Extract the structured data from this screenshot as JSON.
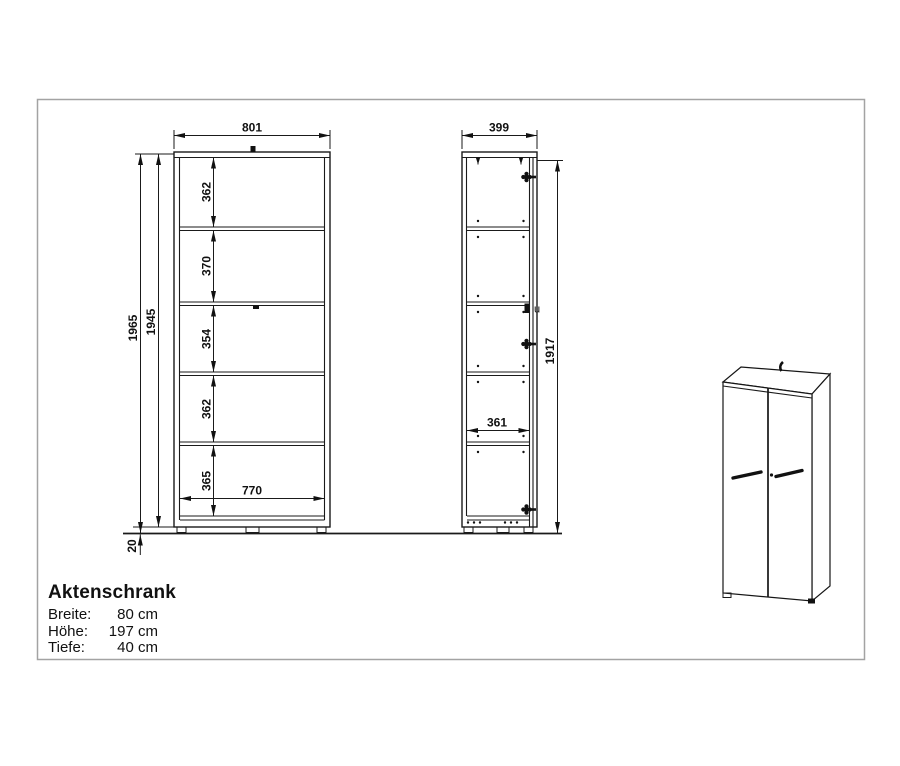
{
  "info": {
    "title": "Aktenschrank",
    "specs": [
      {
        "label": "Breite:",
        "value": "80 cm"
      },
      {
        "label": "Höhe:",
        "value": "197 cm"
      },
      {
        "label": "Tiefe:",
        "value": "40 cm"
      }
    ]
  },
  "drawing": {
    "front_view": {
      "width": "801",
      "interior_width": "770",
      "height_total": "1965",
      "height_body": "1945",
      "plinth_height": "20",
      "compartments": [
        "362",
        "370",
        "354",
        "362",
        "365"
      ]
    },
    "side_view": {
      "depth": "399",
      "height": "1917",
      "interior_depth": "361",
      "catch_symbol": "u"
    }
  },
  "colors": {
    "line": "#1a1a1a",
    "frame_border": "#a3a3a3",
    "background": "#ffffff"
  }
}
